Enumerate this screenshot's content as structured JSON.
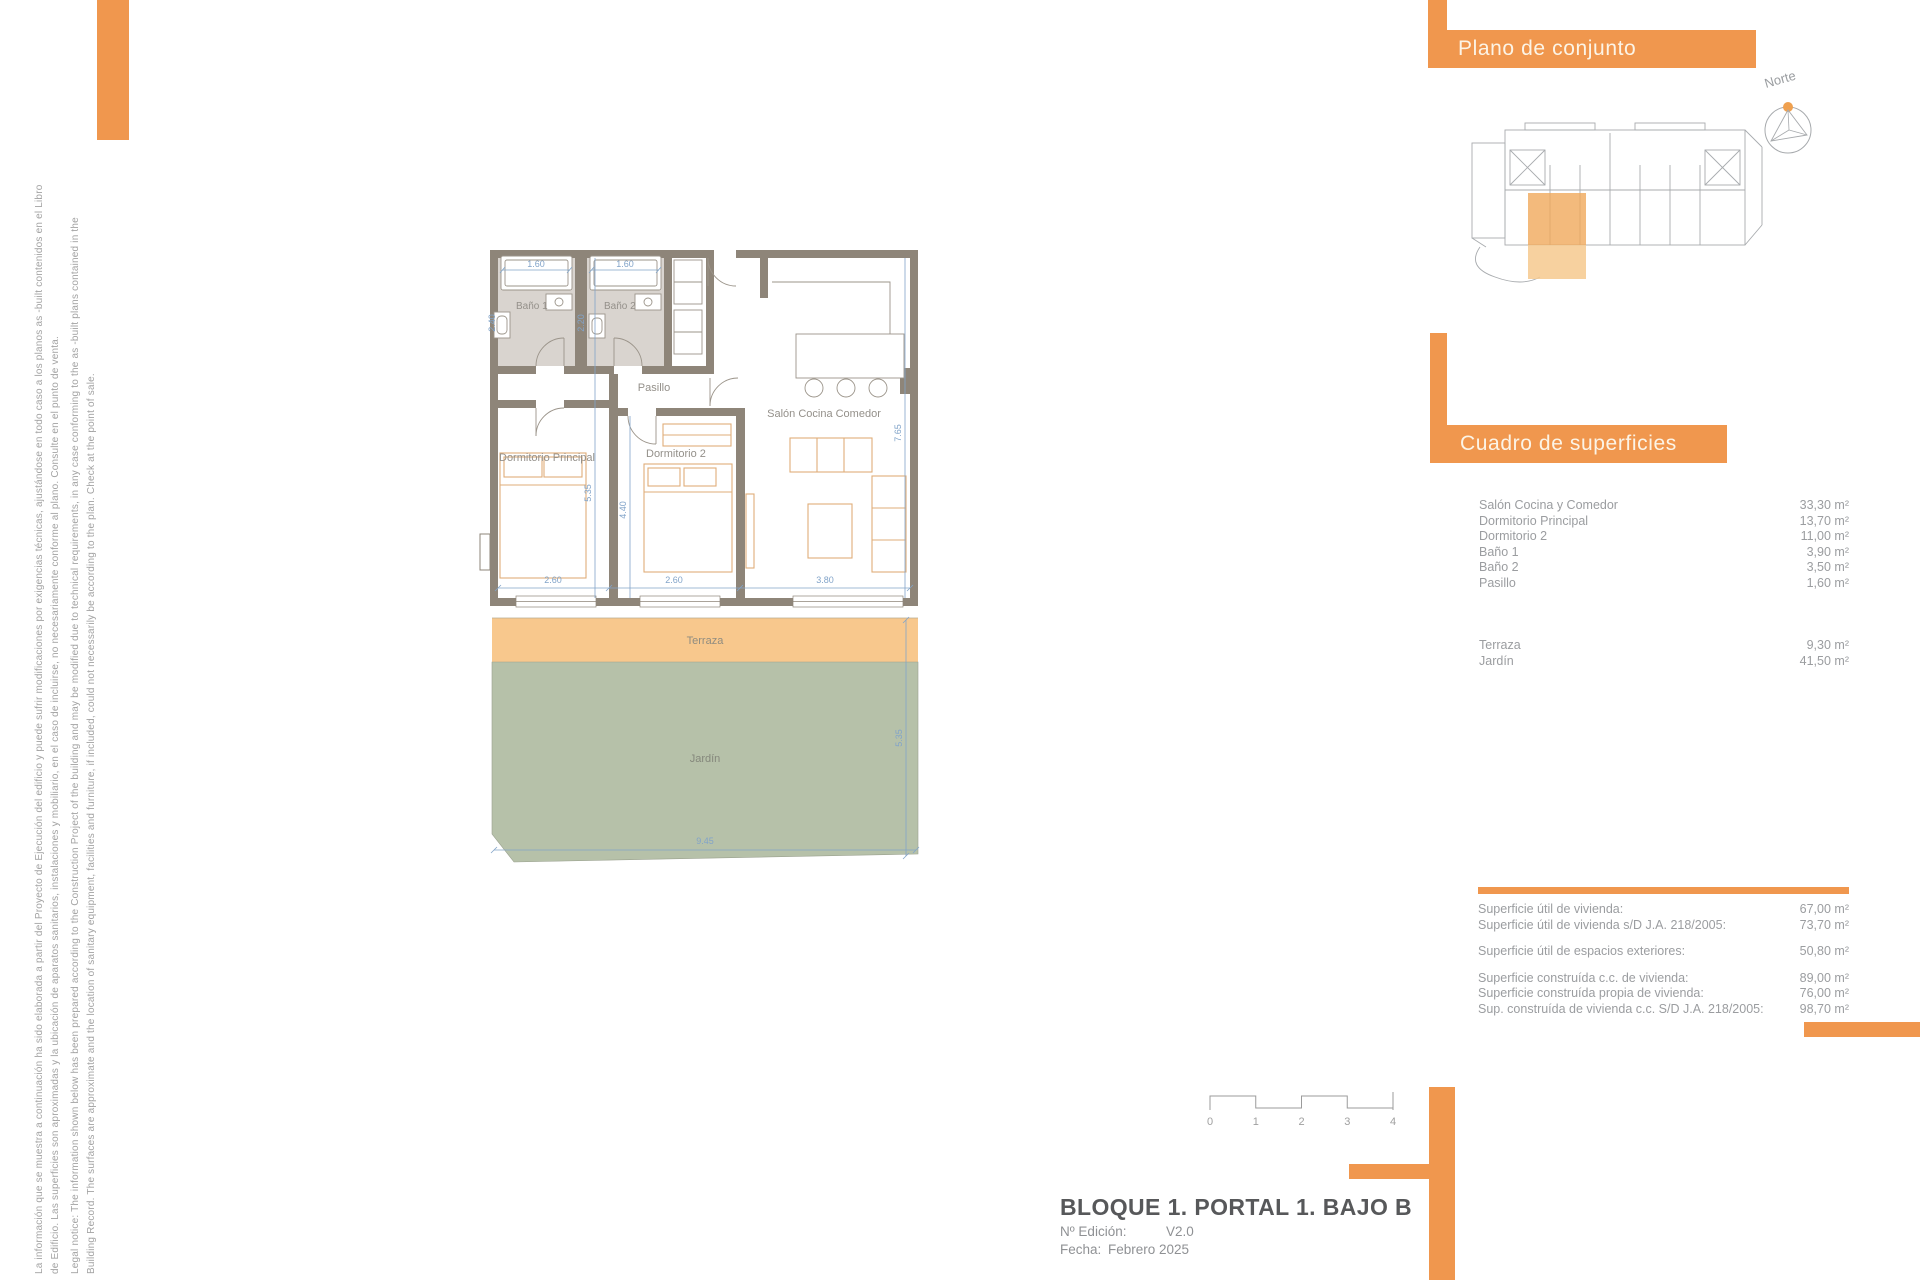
{
  "brand": {
    "orange": "#f0974e",
    "terrace_fill": "#f8c88d",
    "garden_fill": "#b6c1a9",
    "wall_fill": "#8e8579",
    "dim_blue": "#82a4c9"
  },
  "legal": {
    "es1": "La información que se muestra a continuación ha sido elaborada a partir del Proyecto de Ejecución del edificio y puede sufrir modificaciones por exigencias técnicas, ajustándose en todo caso a los planos as -built contenidos en el Libro",
    "es2": "de Edificio. Las superficies son aproximadas y la ubicación de aparatos sanitarios, instalaciones y mobiliario, en el caso de incluirse, no necesariamente conforme al plano. Consulte en el punto de venta.",
    "en1": "Legal notice: The information shown below has been prepared according to the Construction Project of the building and may be modified due to technical requirements, in any case conforming to the as -built plans contained in the",
    "en2": "Building Record. The surfaces are approximate and the location of sanitary equipment, facilities and furniture, if included, could not necessarily be according to the plan. Check at the point of sale."
  },
  "site_plan": {
    "title": "Plano de conjunto",
    "north_label": "Norte"
  },
  "surfaces": {
    "title": "Cuadro de superficies",
    "rows": [
      {
        "label": "Salón Cocina y Comedor",
        "value": "33,30 m²"
      },
      {
        "label": "Dormitorio Principal",
        "value": "13,70 m²"
      },
      {
        "label": "Dormitorio 2",
        "value": "11,00 m²"
      },
      {
        "label": "Baño 1",
        "value": "3,90 m²"
      },
      {
        "label": "Baño 2",
        "value": "3,50 m²"
      },
      {
        "label": "Pasillo",
        "value": "1,60 m²"
      }
    ],
    "outdoor_rows": [
      {
        "label": "Terraza",
        "value": "9,30 m²"
      },
      {
        "label": "Jardín",
        "value": "41,50 m²"
      }
    ]
  },
  "summary": {
    "groups": [
      [
        {
          "label": "Superficie útil de vivienda:",
          "value": "67,00 m²"
        },
        {
          "label": "Superficie útil de vivienda s/D J.A. 218/2005:",
          "value": "73,70 m²"
        }
      ],
      [
        {
          "label": "Superficie útil de espacios exteriores:",
          "value": "50,80 m²"
        }
      ],
      [
        {
          "label": "Superficie construída c.c. de vivienda:",
          "value": "89,00 m²"
        },
        {
          "label": "Superficie construída propia de vivienda:",
          "value": "76,00 m²"
        },
        {
          "label": "Sup. construída de vivienda c.c. S/D J.A. 218/2005:",
          "value": "98,70 m²"
        }
      ]
    ]
  },
  "titleblock": {
    "title": "BLOQUE 1. PORTAL 1. BAJO B",
    "edition_label": "Nº Edición:",
    "edition_value": "V2.0",
    "date_label": "Fecha:",
    "date_value": "Febrero 2025"
  },
  "scalebar": {
    "ticks": [
      "0",
      "1",
      "2",
      "3",
      "4"
    ]
  },
  "plan": {
    "rooms": {
      "bano1": "Baño 1",
      "bano2": "Baño 2",
      "pasillo": "Pasillo",
      "dorm_principal": "Dormitorio Principal",
      "dorm2": "Dormitorio 2",
      "salon": "Salón Cocina Comedor",
      "terraza": "Terraza",
      "jardin": "Jardín"
    },
    "dims": {
      "shower1_w": "1.60",
      "shower2_w": "1.60",
      "bath1_d": "2.40",
      "bath2_d": "2.20",
      "dp_w": "2.60",
      "d2_w": "2.60",
      "salon_w": "3.80",
      "dp_h": "5.35",
      "d2_h": "4.40",
      "salon_h": "7.65",
      "garden_w": "9.45",
      "exterior_h": "5.35"
    }
  }
}
